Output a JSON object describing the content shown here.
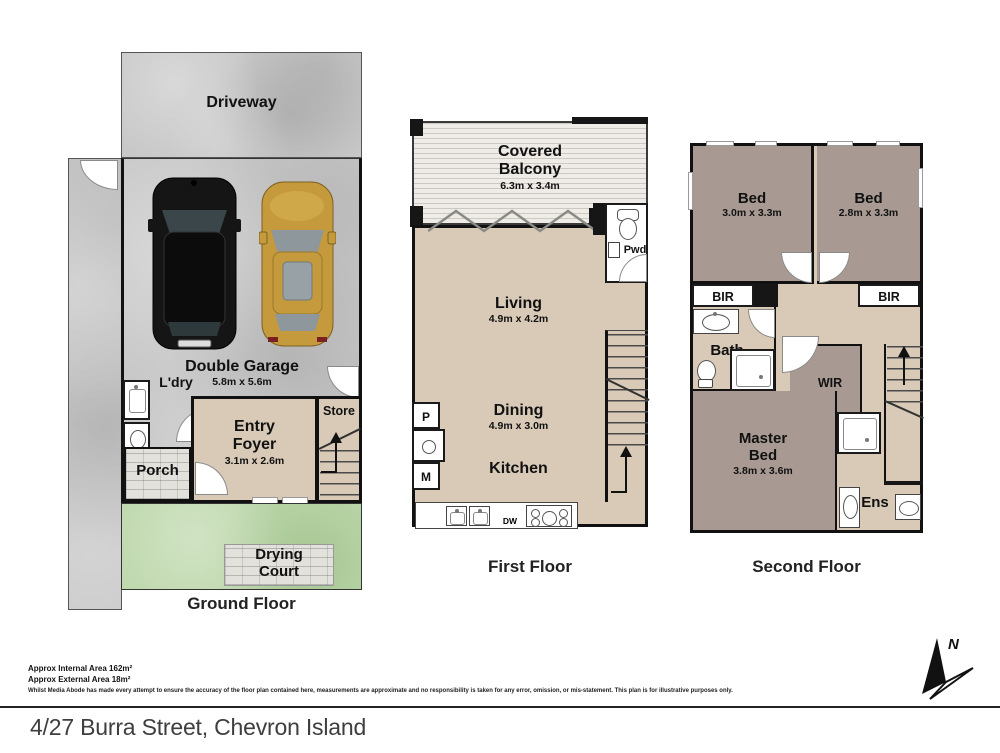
{
  "floors": {
    "ground": {
      "label": "Ground Floor",
      "driveway": "Driveway",
      "garage": {
        "name": "Double Garage",
        "dim": "5.8m x 5.6m"
      },
      "laundry": "L'dry",
      "entry": {
        "line1": "Entry",
        "line2": "Foyer",
        "dim": "3.1m x 2.6m"
      },
      "store": "Store",
      "porch": "Porch",
      "drying": {
        "line1": "Drying",
        "line2": "Court"
      }
    },
    "first": {
      "label": "First Floor",
      "balcony": {
        "line1": "Covered",
        "line2": "Balcony",
        "dim": "6.3m x 3.4m"
      },
      "living": {
        "name": "Living",
        "dim": "4.9m x 4.2m"
      },
      "powder": "Pwd",
      "dining": {
        "name": "Dining",
        "dim": "4.9m x 3.0m"
      },
      "kitchen": "Kitchen",
      "pantry": "P",
      "microwave": "M",
      "dishwasher": "DW"
    },
    "second": {
      "label": "Second Floor",
      "bed1": {
        "name": "Bed",
        "dim": "3.0m x 3.3m"
      },
      "bed2": {
        "name": "Bed",
        "dim": "2.8m x 3.3m"
      },
      "bir_left": "BIR",
      "bir_right": "BIR",
      "bath": "Bath",
      "wir": "WIR",
      "master": {
        "line1": "Master",
        "line2": "Bed",
        "dim": "3.8m x 3.6m"
      },
      "ensuite": "Ens"
    }
  },
  "footer": {
    "internal_area": "Approx Internal Area 162m²",
    "external_area": "Approx External Area 18m²",
    "disclaimer": "Whilst Media Abode has made every attempt to ensure the accuracy of the floor plan contained here, measurements are approximate and no responsibility is taken for any error, omission, or mis-statement. This plan is for illustrative purposes only.",
    "address": "4/27 Burra Street, Chevron Island",
    "compass_north": "N"
  },
  "colors": {
    "floor_beige": "#d9cab8",
    "bedroom_mauve": "#a89a93",
    "concrete_grey": "#c8c8c8",
    "grass_green": "#bdd7ab",
    "wall_black": "#161616",
    "car_black": "#151515",
    "car_gold": "#c49a3c"
  }
}
